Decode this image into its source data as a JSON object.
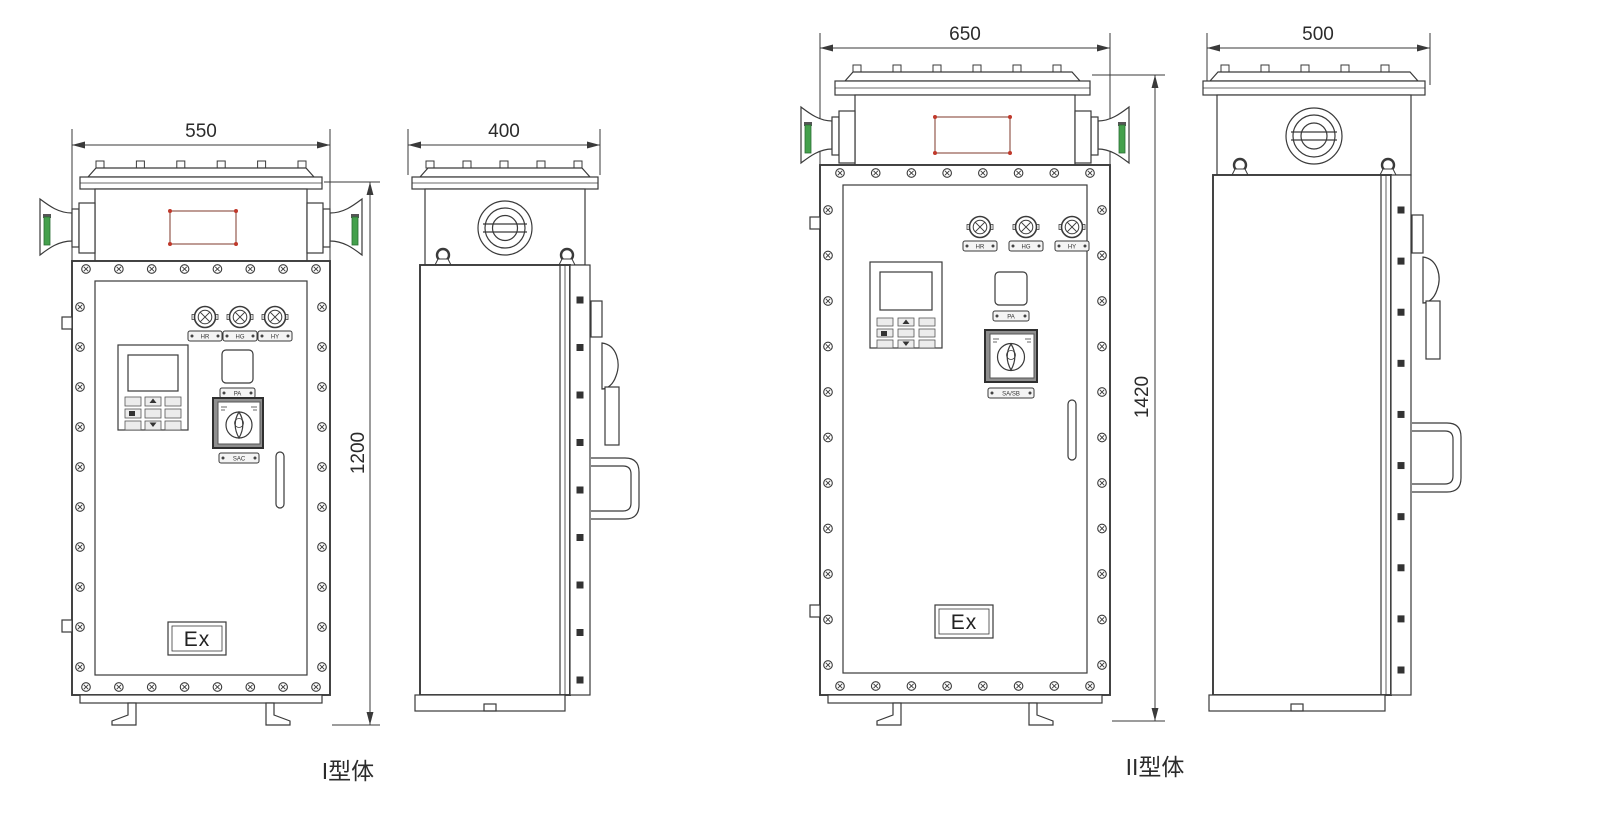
{
  "page": {
    "background": "#ffffff"
  },
  "colors": {
    "line": "#3a3a3a",
    "green_accent": "#44a04c",
    "red_accent": "#c0392b"
  },
  "figures": [
    {
      "name": "Type I cabinet",
      "caption": "I型体",
      "front_view": {
        "width_dim": "550",
        "height_dim": "1200",
        "indicator_labels": [
          "HR",
          "HG",
          "HY"
        ],
        "button_label": "PA",
        "switch_label": "SAC",
        "ex_marking": "Ex"
      },
      "side_view": {
        "depth_dim": "400"
      }
    },
    {
      "name": "Type II cabinet",
      "caption": "II型体",
      "front_view": {
        "width_dim": "650",
        "height_dim": "1420",
        "indicator_labels": [
          "HR",
          "HG",
          "HY"
        ],
        "button_label": "PA",
        "switch_label": "SA/SB",
        "ex_marking": "Ex"
      },
      "side_view": {
        "depth_dim": "500"
      }
    }
  ]
}
